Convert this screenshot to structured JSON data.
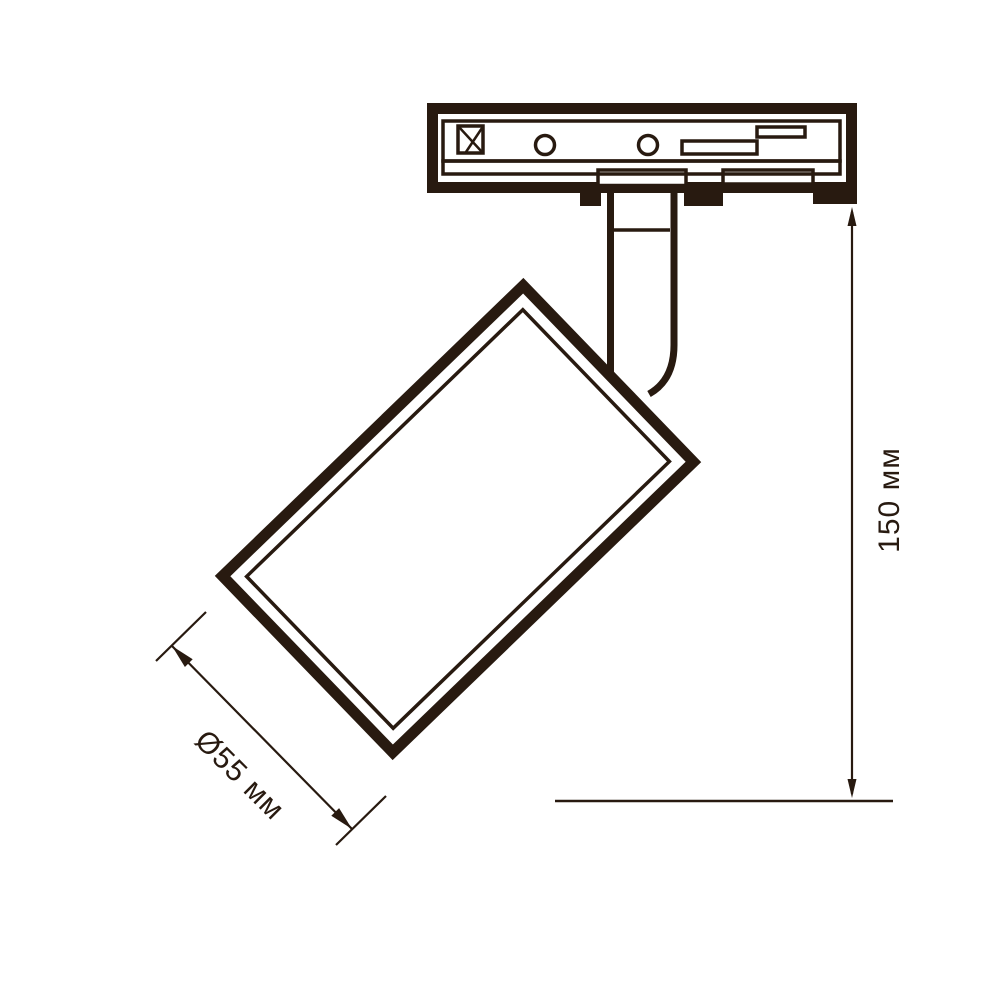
{
  "diagram": {
    "type": "technical-line-drawing",
    "subject": "track-mounted-spotlight-side-view",
    "dimensions": {
      "diameter": {
        "label": "Ø55 мм"
      },
      "height": {
        "label": "150 мм"
      }
    },
    "colors": {
      "ink": "#281a10",
      "background": "#ffffff"
    }
  }
}
